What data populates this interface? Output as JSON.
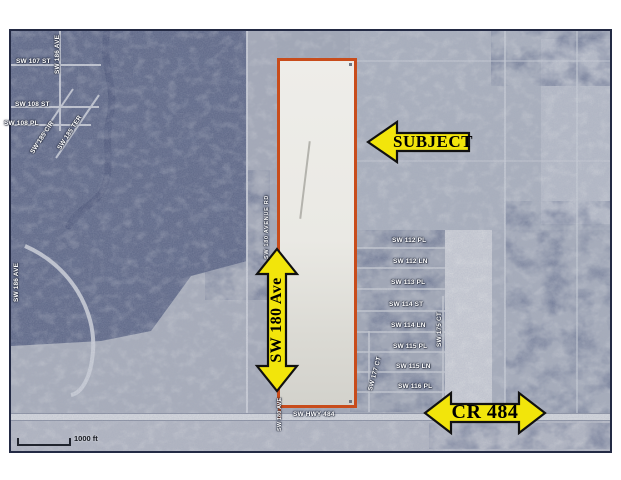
{
  "map_annotations": {
    "subject_arrow_label": "SUBJECT",
    "avenue_arrow_label": "SW 180 Ave",
    "highway_arrow_label": "CR 484",
    "arrow_fill_color": "#f2e50b",
    "arrow_outline_color": "#111111",
    "parcel_outline_color": "#c84c1b"
  },
  "street_labels": [
    {
      "text": "SW 107 ST"
    },
    {
      "text": "SW 186 AVE"
    },
    {
      "text": "SW 108 ST"
    },
    {
      "text": "SW 108 PL"
    },
    {
      "text": "SW 185 CIR"
    },
    {
      "text": "SW 185 TER"
    },
    {
      "text": "SW 180 AVENUE RD"
    },
    {
      "text": "SW 112 PL"
    },
    {
      "text": "SW 112 LN"
    },
    {
      "text": "SW 113 PL"
    },
    {
      "text": "SW 114 ST"
    },
    {
      "text": "SW 114 LN"
    },
    {
      "text": "SW 115 PL"
    },
    {
      "text": "SW 115 LN"
    },
    {
      "text": "SW 116 PL"
    },
    {
      "text": "SW 177 CT"
    },
    {
      "text": "SW 175 CT"
    },
    {
      "text": "SW HWY 484"
    },
    {
      "text": "SW 180 AVE"
    },
    {
      "text": "SW 186 AVE"
    }
  ],
  "scale_bar": {
    "label": "1000 ft"
  }
}
